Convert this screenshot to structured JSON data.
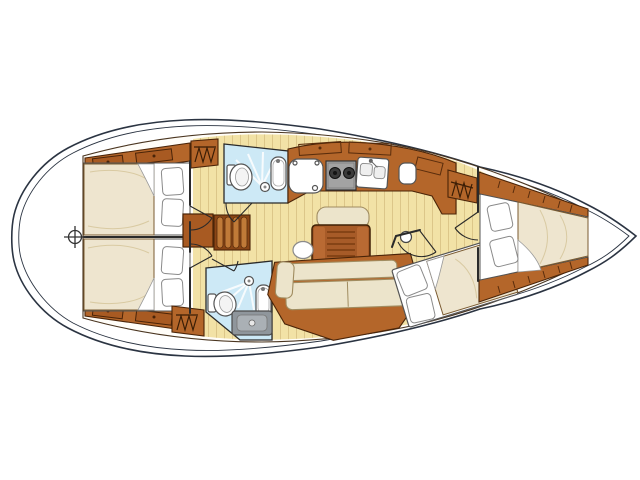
{
  "diagram": {
    "kind": "sailing-yacht-interior-accommodation-plan",
    "orientation": "bow-right",
    "background": "#ffffff"
  },
  "palette": {
    "hull_line": "#2b3442",
    "wall_line": "#2a2a2a",
    "wood": "#b4662a",
    "wood_light": "#c07a38",
    "wood_outline": "#4a2408",
    "floor": "#f2e2a6",
    "mattress": "#eee5cf",
    "cushion": "#ece4cb",
    "pillow": "#ffffff",
    "shower_floor": "#cde9f6",
    "fixture_white": "#ffffff",
    "stove_gray": "#a3a3a3",
    "tray_gray": "#8f969c",
    "table_wood": "#a75b28"
  },
  "compartments": [
    {
      "id": "forward-cabin",
      "features": [
        "double-berth",
        "two-pillows",
        "hull-shelves",
        "hanging-locker"
      ]
    },
    {
      "id": "mid-cabin",
      "features": [
        "angled-double-berth",
        "two-pillows",
        "turned-down-sheet"
      ]
    },
    {
      "id": "saloon",
      "features": [
        "slatted-table",
        "bench-seat",
        "l-settee",
        "oval-stool",
        "round-fitting"
      ]
    },
    {
      "id": "galley",
      "features": [
        "icebox",
        "two-burner-stove",
        "double-sink",
        "overhead-lockers",
        "counter-corner"
      ]
    },
    {
      "id": "upper-head",
      "features": [
        "toilet",
        "washbasin",
        "shower-head",
        "wet-floor"
      ]
    },
    {
      "id": "lower-head",
      "features": [
        "toilet",
        "washbasin",
        "shower-head",
        "wet-floor",
        "shower-tray"
      ]
    },
    {
      "id": "companionway",
      "features": [
        "four-tread-steps",
        "landing"
      ]
    },
    {
      "id": "upper-aft-cabin",
      "features": [
        "double-berth",
        "two-pillows",
        "locker-strip-with-drawers",
        "hanging-locker"
      ]
    },
    {
      "id": "lower-aft-cabin",
      "features": [
        "double-berth",
        "two-pillows",
        "locker-strip-with-drawers",
        "hanging-locker"
      ]
    }
  ],
  "markers": [
    {
      "id": "crosshair-marker",
      "position": "aft-centerline"
    }
  ]
}
